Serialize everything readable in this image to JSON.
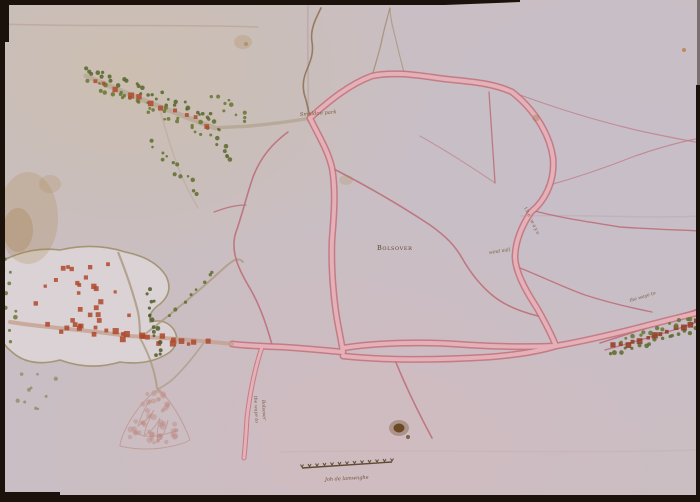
{
  "meta": {
    "title": "Early manuscript map of roads around a town",
    "type": "hand-drawn map"
  },
  "colors": {
    "paper": "#c9bec3",
    "road_edge": "#c2717c",
    "road_fill": "#e7b3ba",
    "thin_road": "#bd6b76",
    "brown_line": "#8a6a4a",
    "grey_road": "#b5a795",
    "tree_green": "#5a6a2c",
    "house_red": "#b0492c",
    "ink": "#5b4530",
    "frame": "#1a120b"
  },
  "labels": {
    "settlement": "Bolsover",
    "park": "Smaldon park",
    "mill": "wind mill",
    "road_name": "the waye",
    "right_edge_road": "the waye to",
    "sw_road_line1": "the waye to",
    "sw_road_line2": "Bolsover",
    "signature": "Joh de lamwnghe"
  },
  "scale_bar": {
    "ticks": 13
  },
  "map": {
    "clusters": [
      {
        "name_each": "tree-dot",
        "type": "row",
        "x1": 86,
        "y1": 68,
        "x2": 206,
        "y2": 116,
        "n": 30,
        "spread": 6,
        "size": 1.9,
        "color": "#55662a",
        "seed": 11
      },
      {
        "name_each": "tree-dot",
        "type": "row",
        "x1": 90,
        "y1": 86,
        "x2": 212,
        "y2": 132,
        "n": 30,
        "spread": 6,
        "size": 1.9,
        "color": "#66762f",
        "seed": 12
      },
      {
        "name_each": "house-dot",
        "type": "row",
        "x1": 95,
        "y1": 82,
        "x2": 208,
        "y2": 124,
        "n": 11,
        "spread": 3,
        "size": 2.6,
        "color": "#b0492c",
        "shape": "square",
        "seed": 13
      },
      {
        "name_each": "tree-dot",
        "type": "row",
        "x1": 208,
        "y1": 118,
        "x2": 232,
        "y2": 164,
        "n": 12,
        "spread": 5,
        "size": 1.8,
        "color": "#5a6a2c",
        "seed": 14
      },
      {
        "name_each": "tree-dot",
        "type": "row",
        "x1": 215,
        "y1": 98,
        "x2": 250,
        "y2": 120,
        "n": 10,
        "spread": 7,
        "size": 1.8,
        "color": "#66762f",
        "seed": 15
      },
      {
        "name_each": "tree-dot",
        "type": "row",
        "x1": 150,
        "y1": 145,
        "x2": 196,
        "y2": 192,
        "n": 13,
        "spread": 6,
        "size": 1.8,
        "color": "#5f6f2d",
        "seed": 16
      },
      {
        "name_each": "house-dot",
        "type": "scatter",
        "cx": 88,
        "cy": 298,
        "rx": 55,
        "ry": 38,
        "n": 24,
        "size": 2.1,
        "color": "#b0492c",
        "shape": "square",
        "seed": 17
      },
      {
        "name_each": "tree-dot",
        "type": "row",
        "x1": 6,
        "y1": 258,
        "x2": 14,
        "y2": 338,
        "n": 10,
        "spread": 6,
        "size": 1.9,
        "color": "#6a7a35",
        "seed": 18
      },
      {
        "name_each": "house-dot",
        "type": "row",
        "x1": 52,
        "y1": 326,
        "x2": 205,
        "y2": 345,
        "n": 24,
        "spread": 5,
        "size": 2.4,
        "color": "#ad462a",
        "shape": "square",
        "seed": 19
      },
      {
        "name_each": "tree-dot",
        "type": "row",
        "x1": 148,
        "y1": 290,
        "x2": 160,
        "y2": 356,
        "n": 16,
        "spread": 4,
        "size": 1.9,
        "color": "#4f5c28",
        "seed": 20
      },
      {
        "name_each": "tree-dot",
        "type": "row",
        "x1": 170,
        "y1": 316,
        "x2": 214,
        "y2": 272,
        "n": 8,
        "spread": 4,
        "size": 1.7,
        "color": "#5f6f2d",
        "seed": 21
      },
      {
        "name_each": "tree-dot",
        "type": "row",
        "x1": 610,
        "y1": 355,
        "x2": 698,
        "y2": 330,
        "n": 16,
        "spread": 2.5,
        "size": 2.0,
        "color": "#5a6a2c",
        "seed": 22
      },
      {
        "name_each": "house-dot",
        "type": "row",
        "x1": 615,
        "y1": 347,
        "x2": 695,
        "y2": 322,
        "n": 13,
        "spread": 2.5,
        "size": 2.4,
        "color": "#8e3b22",
        "shape": "square",
        "seed": 23
      },
      {
        "name_each": "tree-dot",
        "type": "row",
        "x1": 622,
        "y1": 340,
        "x2": 698,
        "y2": 316,
        "n": 14,
        "spread": 2.5,
        "size": 1.9,
        "color": "#66762f",
        "seed": 24
      },
      {
        "name_each": "tree-dot",
        "type": "scatter",
        "cx": 38,
        "cy": 392,
        "rx": 22,
        "ry": 34,
        "n": 10,
        "size": 1.7,
        "color": "#77723d",
        "opacity": 0.55,
        "seed": 25
      },
      {
        "name_each": "scrub-dot",
        "type": "scatter",
        "cx": 155,
        "cy": 405,
        "rx": 14,
        "ry": 15,
        "n": 18,
        "size": 2.4,
        "color": "#c08f86",
        "opacity": 0.5,
        "seed": 26
      },
      {
        "name_each": "scrub-dot",
        "type": "scatter",
        "cx": 153,
        "cy": 430,
        "rx": 30,
        "ry": 15,
        "n": 32,
        "size": 2.6,
        "color": "#bd8a81",
        "opacity": 0.45,
        "seed": 27
      }
    ]
  }
}
